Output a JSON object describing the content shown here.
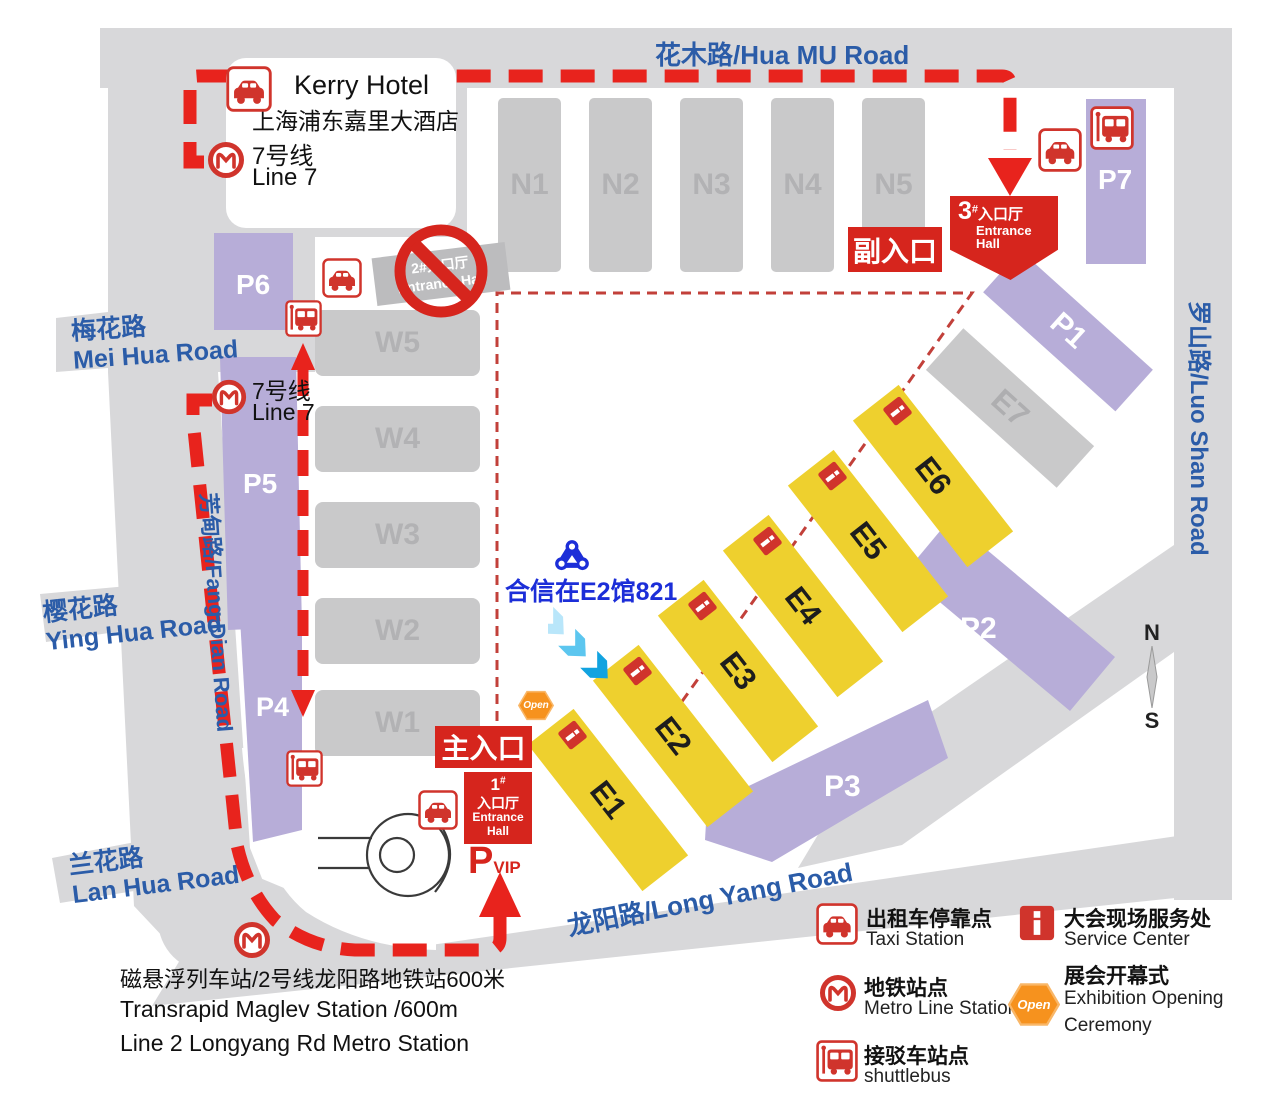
{
  "roads": {
    "hua_mu": "花木路/Hua MU Road",
    "luo_shan": "罗山路/Luo Shan Road",
    "long_yang": "龙阳路/Long Yang Road",
    "fang_dian": "芳甸路/Fang Dian Road",
    "mei_hua_cn": "梅花路",
    "mei_hua_en": "Mei Hua Road",
    "ying_hua_cn": "樱花路",
    "ying_hua_en": "Ying Hua Road",
    "lan_hua_cn": "兰花路",
    "lan_hua_en": "Lan Hua Road"
  },
  "hotel": {
    "name_en": "Kerry Hotel",
    "name_cn": "上海浦东嘉里大酒店",
    "line_cn": "7号线",
    "line_en": "Line 7"
  },
  "metro_west": {
    "cn": "7号线",
    "en": "Line 7"
  },
  "halls": {
    "north": [
      "N1",
      "N2",
      "N3",
      "N4",
      "N5"
    ],
    "west": [
      "W5",
      "W4",
      "W3",
      "W2",
      "W1"
    ],
    "east": [
      "E1",
      "E2",
      "E3",
      "E4",
      "E5",
      "E6"
    ],
    "e7": "E7"
  },
  "parking": {
    "p1": "P1",
    "p2": "P2",
    "p3": "P3",
    "p4": "P4",
    "p5": "P5",
    "p6": "P6",
    "p7": "P7"
  },
  "entrances": {
    "main": "主入口",
    "secondary": "副入口",
    "hall1": {
      "num": "1",
      "hash": "#",
      "cn": "入口厅",
      "en1": "Entrance",
      "en2": "Hall"
    },
    "hall3": {
      "num": "3",
      "hash": "#",
      "cn": "入口厅",
      "en1": "Entrance",
      "en2": "Hall"
    },
    "closed": {
      "line1": "2#入口厅",
      "line2": "Entrance Hall"
    },
    "vip": {
      "p": "P",
      "vip": "VIP"
    }
  },
  "booth": {
    "label": "合信在E2馆821"
  },
  "open_label": "Open",
  "legend": {
    "taxi_cn": "出租车停靠点",
    "taxi_en": "Taxi Station",
    "metro_cn": "地铁站点",
    "metro_en": "Metro Line Station",
    "shuttle_cn": "接驳车站点",
    "shuttle_en": "shuttlebus",
    "service_cn": "大会现场服务处",
    "service_en": "Service Center",
    "open_cn": "展会开幕式",
    "open_en": "Exhibition Opening Ceremony"
  },
  "footer": {
    "line1": "磁悬浮列车站/2号线龙阳路地铁站600米",
    "line2": "Transrapid Maglev Station /600m",
    "line3": "Line 2 Longyang Rd Metro Station"
  },
  "compass": {
    "n": "N",
    "s": "S"
  },
  "colors": {
    "red": "#d6251d",
    "purple": "#b7add8",
    "yellow": "#eed02e",
    "hall_gray": "#c9c9ca",
    "road_gray": "#d8d8da",
    "road_text_blue": "#2b5ca8",
    "booth_blue": "#1c2ed8",
    "orange": "#f6921e"
  }
}
